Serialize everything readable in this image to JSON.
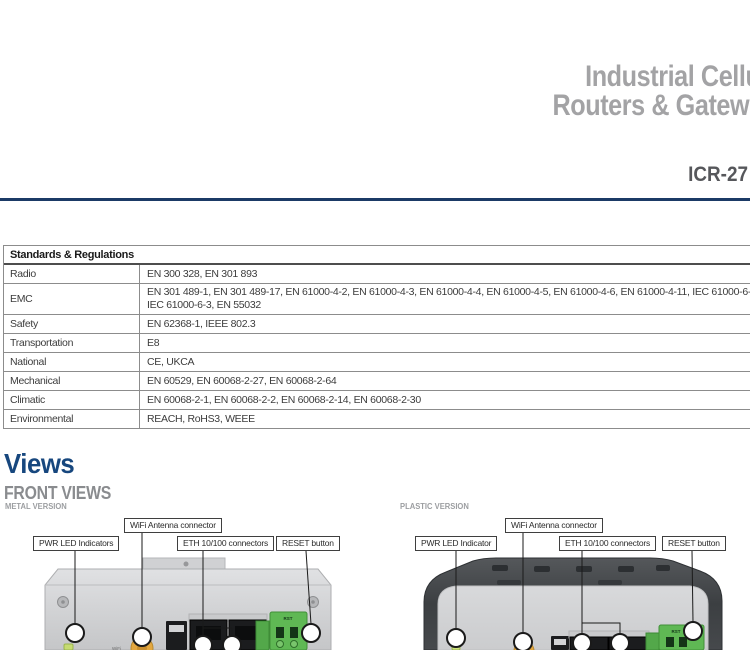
{
  "header": {
    "title_line1": "Industrial Cellular",
    "title_line2": "Routers & Gateways",
    "model": "ICR-27"
  },
  "colors": {
    "accent_navy": "#1b3a66",
    "section_heading_navy": "#17477e",
    "title_gray": "#a3a3a5",
    "model_gray": "#56575b",
    "table_border_gray": "#8c8c8c",
    "terminal_green": "#5fb854",
    "antenna_gold": "#e3a73f"
  },
  "standards_table": {
    "header": "Standards & Regulations",
    "rows": [
      {
        "label": "Radio",
        "value": "EN 300 328, EN 301 893"
      },
      {
        "label": "EMC",
        "value": "EN 301 489-1, EN 301 489-17, EN 61000-4-2, EN 61000-4-3, EN 61000-4-4, EN 61000-4-5, EN 61000-4-6, EN 61000-4-11, IEC 61000-6-1,",
        "value2": "IEC 61000-6-3, EN 55032"
      },
      {
        "label": "Safety",
        "value": "EN 62368-1, IEEE 802.3"
      },
      {
        "label": "Transportation",
        "value": "E8"
      },
      {
        "label": "National",
        "value": "CE, UKCA"
      },
      {
        "label": "Mechanical",
        "value": "EN 60529, EN 60068-2-27, EN 60068-2-64"
      },
      {
        "label": "Climatic",
        "value": "EN 60068-2-1, EN 60068-2-2, EN 60068-2-14, EN 60068-2-30"
      },
      {
        "label": "Environmental",
        "value": "REACH, RoHS3, WEEE"
      }
    ]
  },
  "views": {
    "section_title": "Views",
    "subsection_title": "FRONT VIEWS",
    "metal": {
      "variant_label": "METAL VERSION",
      "callouts": {
        "wifi": "WiFi Antenna connector",
        "pwr": "PWR LED Indicators",
        "eth": "ETH 10/100 connectors",
        "reset": "RESET button"
      },
      "port_label_rst": "RST",
      "port_label_wifi": "WiFi"
    },
    "plastic": {
      "variant_label": "PLASTIC VERSION",
      "callouts": {
        "wifi": "WiFi Antenna connector",
        "pwr": "PWR LED Indicator",
        "eth": "ETH 10/100 connectors",
        "reset": "RESET button"
      },
      "port_label_rst": "RST"
    }
  }
}
